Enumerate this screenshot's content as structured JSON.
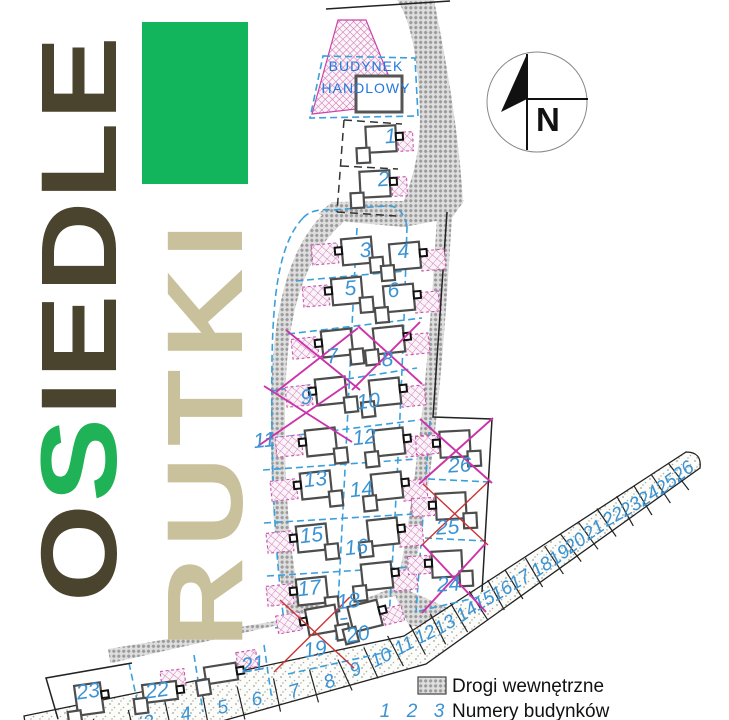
{
  "logo": {
    "word1_parts": [
      "O",
      "S",
      "IEDLE"
    ],
    "word2": "RUTKI",
    "accent_green": "#12b45c",
    "dark_olive": "#4a432d",
    "tan": "#c9c09c"
  },
  "plan": {
    "compass_label": "N",
    "commercial_building": {
      "line1": "BUDYNEK",
      "line2": "HANDLOWY"
    },
    "number_color": "#3a93d4",
    "cross_colors": {
      "magenta": "#cc33aa",
      "red": "#cc3333"
    },
    "plots": [
      {
        "number": "1",
        "crossed": false
      },
      {
        "number": "2",
        "crossed": false
      },
      {
        "number": "3",
        "crossed": false
      },
      {
        "number": "4",
        "crossed": false
      },
      {
        "number": "5",
        "crossed": false
      },
      {
        "number": "6",
        "crossed": false
      },
      {
        "number": "7",
        "crossed": true,
        "cross_color": "magenta"
      },
      {
        "number": "8",
        "crossed": true,
        "cross_color": "magenta"
      },
      {
        "number": "9",
        "crossed": true,
        "cross_color": "magenta"
      },
      {
        "number": "10",
        "crossed": false
      },
      {
        "number": "11",
        "crossed": false
      },
      {
        "number": "12",
        "crossed": false
      },
      {
        "number": "13",
        "crossed": false
      },
      {
        "number": "14",
        "crossed": false
      },
      {
        "number": "15",
        "crossed": false
      },
      {
        "number": "16",
        "crossed": false
      },
      {
        "number": "17",
        "crossed": false
      },
      {
        "number": "18",
        "crossed": false
      },
      {
        "number": "19",
        "crossed": true,
        "cross_color": "red"
      },
      {
        "number": "20",
        "crossed": false
      },
      {
        "number": "21",
        "crossed": false
      },
      {
        "number": "22",
        "crossed": false
      },
      {
        "number": "23",
        "crossed": false
      },
      {
        "number": "24",
        "crossed": true,
        "cross_color": "magenta"
      },
      {
        "number": "25",
        "crossed": true,
        "cross_color": "red"
      },
      {
        "number": "26",
        "crossed": true,
        "cross_color": "magenta"
      }
    ],
    "road_strip_numbers": [
      "1",
      "2",
      "3",
      "4",
      "5",
      "6",
      "7",
      "8",
      "9",
      "10",
      "11",
      "12",
      "13",
      "14",
      "15",
      "16",
      "17",
      "18",
      "19",
      "20",
      "21",
      "22",
      "23",
      "24",
      "25",
      "26"
    ]
  },
  "legend": {
    "roads_label": "Drogi wewnętrzne",
    "numbers_samples": [
      "1",
      "2",
      "3"
    ],
    "numbers_label": "Numery budynków"
  }
}
